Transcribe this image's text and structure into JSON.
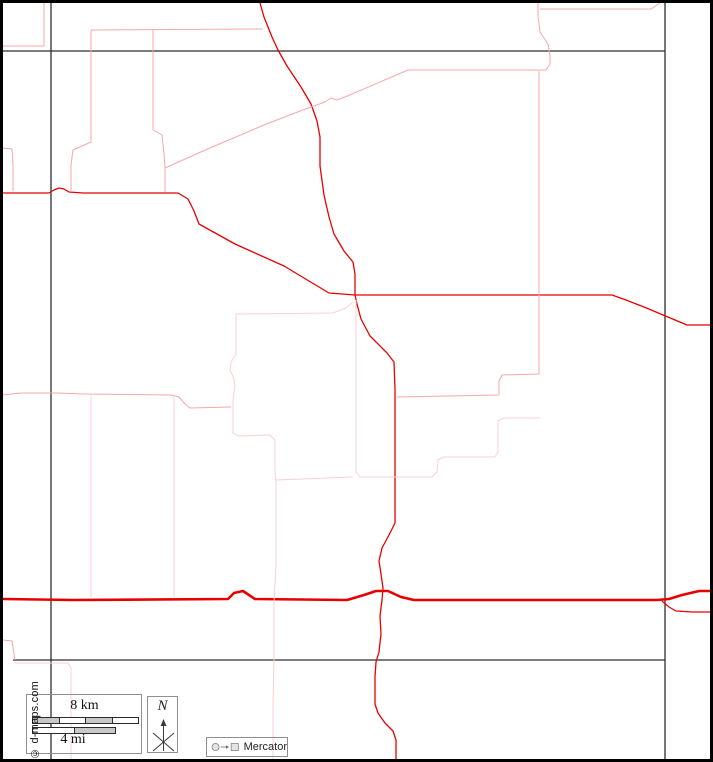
{
  "meta": {
    "width": 713,
    "height": 762
  },
  "colors": {
    "road_red": "#e80000",
    "boundary_pink": "#f4a9a9",
    "boundary_pale": "#f9d0d0",
    "neatline": "#2e2e2e",
    "outer_border": "#000000",
    "box_border": "#8f8f8f",
    "bar_gray": "#c8c8c8",
    "icon_fill": "#e3e3e3",
    "icon_stroke": "#6f6f6f"
  },
  "scale_bar": {
    "km_label": "8 km",
    "mi_label": "4 mi",
    "km_segments": [
      "gray",
      "white",
      "gray",
      "white"
    ],
    "mi_segments": [
      "white",
      "gray"
    ]
  },
  "compass": {
    "label": "N"
  },
  "projection": {
    "label": "Mercator"
  },
  "copyright": "© d-maps.com",
  "map": {
    "lines": [
      {
        "name": "neatline-vertical-west",
        "color": "neatline",
        "width": 1.3,
        "points": [
          [
            48,
            0
          ],
          [
            48,
            759
          ]
        ]
      },
      {
        "name": "neatline-vertical-east",
        "color": "neatline",
        "width": 1.3,
        "points": [
          [
            662,
            0
          ],
          [
            662,
            759
          ]
        ]
      },
      {
        "name": "neatline-horizontal-north",
        "color": "neatline",
        "width": 1.3,
        "points": [
          [
            0,
            48
          ],
          [
            662,
            48
          ]
        ]
      },
      {
        "name": "neatline-horizontal-south",
        "color": "neatline",
        "width": 1.3,
        "points": [
          [
            10,
            657
          ],
          [
            662,
            657
          ]
        ]
      },
      {
        "name": "road-north-south",
        "color": "road_red",
        "width": 1.3,
        "points": [
          [
            257,
            0
          ],
          [
            261,
            14
          ],
          [
            269,
            34
          ],
          [
            275,
            47
          ],
          [
            284,
            63
          ],
          [
            298,
            84
          ],
          [
            308,
            101
          ],
          [
            314,
            118
          ],
          [
            317,
            134
          ],
          [
            317,
            163
          ],
          [
            321,
            192
          ],
          [
            326,
            214
          ],
          [
            331,
            231
          ],
          [
            341,
            248
          ],
          [
            350,
            259
          ],
          [
            352,
            271
          ],
          [
            352,
            292
          ],
          [
            354,
            301
          ],
          [
            358,
            316
          ],
          [
            367,
            333
          ],
          [
            384,
            350
          ],
          [
            391,
            359
          ],
          [
            392,
            386
          ],
          [
            392,
            520
          ],
          [
            386,
            532
          ],
          [
            379,
            545
          ],
          [
            376,
            558
          ],
          [
            378,
            571
          ],
          [
            380,
            585
          ],
          [
            379,
            597
          ],
          [
            377,
            613
          ],
          [
            378,
            631
          ],
          [
            376,
            649
          ],
          [
            373,
            659
          ],
          [
            372,
            674
          ],
          [
            372,
            701
          ],
          [
            375,
            710
          ],
          [
            382,
            720
          ],
          [
            390,
            728
          ],
          [
            393,
            737
          ],
          [
            393,
            759
          ]
        ]
      },
      {
        "name": "road-east-west",
        "color": "road_red",
        "width": 1.3,
        "points": [
          [
            0,
            190
          ],
          [
            46,
            190
          ],
          [
            51,
            187
          ],
          [
            56,
            185
          ],
          [
            61,
            186
          ],
          [
            66,
            189
          ],
          [
            80,
            190
          ],
          [
            175,
            190
          ],
          [
            185,
            196
          ],
          [
            191,
            208
          ],
          [
            196,
            221
          ],
          [
            232,
            241
          ],
          [
            281,
            263
          ],
          [
            326,
            290
          ],
          [
            352,
            292
          ],
          [
            560,
            292
          ],
          [
            609,
            292
          ],
          [
            623,
            297
          ],
          [
            641,
            304
          ],
          [
            684,
            322
          ],
          [
            713,
            322
          ]
        ]
      },
      {
        "name": "highway-main",
        "color": "road_red",
        "width": 2.6,
        "points": [
          [
            0,
            596
          ],
          [
            70,
            597
          ],
          [
            225,
            596
          ],
          [
            231,
            590
          ],
          [
            240,
            588
          ],
          [
            252,
            596
          ],
          [
            344,
            597
          ],
          [
            361,
            592
          ],
          [
            373,
            588
          ],
          [
            385,
            588
          ],
          [
            398,
            594
          ],
          [
            411,
            597
          ],
          [
            654,
            597
          ],
          [
            666,
            596
          ],
          [
            679,
            592
          ],
          [
            696,
            588
          ],
          [
            713,
            588
          ]
        ]
      },
      {
        "name": "highway-branch-southeast",
        "color": "road_red",
        "width": 1.2,
        "points": [
          [
            659,
            598
          ],
          [
            666,
            604
          ],
          [
            673,
            608
          ],
          [
            690,
            609
          ],
          [
            713,
            609
          ]
        ]
      },
      {
        "name": "boundary-topleft-corner",
        "color": "boundary_pink",
        "width": 1,
        "points": [
          [
            0,
            43
          ],
          [
            41,
            43
          ],
          [
            41,
            0
          ]
        ]
      },
      {
        "name": "boundary-top-horizontal",
        "color": "boundary_pink",
        "width": 1,
        "points": [
          [
            88,
            27
          ],
          [
            260,
            26
          ]
        ]
      },
      {
        "name": "boundary-west-vertical",
        "color": "boundary_pink",
        "width": 1,
        "points": [
          [
            88,
            27
          ],
          [
            88,
            139
          ],
          [
            70,
            147
          ],
          [
            68,
            162
          ],
          [
            68,
            189
          ]
        ]
      },
      {
        "name": "boundary-mid-vertical",
        "color": "boundary_pink",
        "width": 1,
        "points": [
          [
            150,
            26
          ],
          [
            150,
            127
          ],
          [
            159,
            132
          ],
          [
            161,
            151
          ],
          [
            162,
            165
          ],
          [
            162,
            189
          ]
        ]
      },
      {
        "name": "boundary-diagonal-northeast",
        "color": "boundary_pink",
        "width": 1,
        "points": [
          [
            162,
            165
          ],
          [
            200,
            148
          ],
          [
            261,
            122
          ],
          [
            297,
            108
          ],
          [
            322,
            99
          ],
          [
            328,
            95
          ],
          [
            334,
            97
          ],
          [
            342,
            94
          ],
          [
            405,
            67
          ],
          [
            543,
            67
          ]
        ]
      },
      {
        "name": "boundary-northeast-vertical-top",
        "color": "boundary_pink",
        "width": 1,
        "points": [
          [
            535,
            0
          ],
          [
            535,
            13
          ],
          [
            537,
            29
          ],
          [
            545,
            41
          ],
          [
            547,
            53
          ],
          [
            547,
            61
          ],
          [
            543,
            67
          ]
        ]
      },
      {
        "name": "boundary-topright-horizontal",
        "color": "boundary_pink",
        "width": 1,
        "points": [
          [
            537,
            6
          ],
          [
            648,
            6
          ],
          [
            657,
            0
          ]
        ]
      },
      {
        "name": "boundary-east-step-down",
        "color": "boundary_pink",
        "width": 1,
        "points": [
          [
            536,
            68
          ],
          [
            536,
            371
          ],
          [
            499,
            372
          ],
          [
            496,
            378
          ],
          [
            496,
            392
          ],
          [
            394,
            394
          ]
        ]
      },
      {
        "name": "boundary-west-horizontal",
        "color": "boundary_pink",
        "width": 1,
        "points": [
          [
            0,
            392
          ],
          [
            18,
            390
          ],
          [
            55,
            390
          ],
          [
            80,
            391
          ],
          [
            168,
            392
          ],
          [
            176,
            394
          ],
          [
            182,
            401
          ],
          [
            187,
            405
          ],
          [
            228,
            404
          ]
        ]
      },
      {
        "name": "boundary-left-edge-hook-north",
        "color": "boundary_pink",
        "width": 1,
        "points": [
          [
            0,
            145
          ],
          [
            9,
            146
          ],
          [
            10,
            161
          ],
          [
            10,
            188
          ]
        ]
      },
      {
        "name": "boundary-left-edge-hook-south",
        "color": "boundary_pink",
        "width": 1,
        "points": [
          [
            0,
            637
          ],
          [
            9,
            638
          ],
          [
            11,
            651
          ],
          [
            12,
            657
          ]
        ]
      },
      {
        "name": "boundary-center-steps",
        "color": "boundary_pale",
        "width": 1,
        "points": [
          [
            353,
            297
          ],
          [
            353,
            469
          ],
          [
            357,
            474
          ],
          [
            429,
            474
          ],
          [
            434,
            469
          ],
          [
            435,
            457
          ],
          [
            441,
            454
          ],
          [
            492,
            454
          ],
          [
            495,
            449
          ],
          [
            495,
            418
          ],
          [
            501,
            415
          ],
          [
            537,
            415
          ]
        ]
      },
      {
        "name": "boundary-center-connector",
        "color": "boundary_pale",
        "width": 1,
        "points": [
          [
            273,
            477
          ],
          [
            350,
            474
          ]
        ]
      },
      {
        "name": "boundary-center-horizontal",
        "color": "boundary_pale",
        "width": 1,
        "points": [
          [
            233,
            311
          ],
          [
            330,
            310
          ],
          [
            343,
            305
          ],
          [
            350,
            299
          ]
        ]
      },
      {
        "name": "boundary-center-vertical-long",
        "color": "boundary_pale",
        "width": 1,
        "points": [
          [
            233,
            311
          ],
          [
            233,
            351
          ],
          [
            228,
            359
          ],
          [
            227,
            367
          ],
          [
            231,
            376
          ],
          [
            232,
            384
          ],
          [
            230,
            396
          ],
          [
            230,
            430
          ],
          [
            235,
            433
          ],
          [
            267,
            432
          ],
          [
            272,
            437
          ],
          [
            272,
            470
          ],
          [
            273,
            479
          ],
          [
            273,
            560
          ],
          [
            271,
            600
          ],
          [
            271,
            656
          ],
          [
            270,
            702
          ],
          [
            270,
            758
          ]
        ]
      },
      {
        "name": "boundary-vertical-171",
        "color": "boundary_pale",
        "width": 1,
        "points": [
          [
            171,
            392
          ],
          [
            171,
            594
          ]
        ]
      },
      {
        "name": "boundary-vertical-88",
        "color": "boundary_pale",
        "width": 1,
        "points": [
          [
            88,
            393
          ],
          [
            88,
            594
          ]
        ]
      },
      {
        "name": "boundary-bottomleft-steps",
        "color": "boundary_pale",
        "width": 1,
        "points": [
          [
            12,
            660
          ],
          [
            65,
            660
          ],
          [
            68,
            665
          ],
          [
            68,
            757
          ]
        ]
      }
    ]
  }
}
